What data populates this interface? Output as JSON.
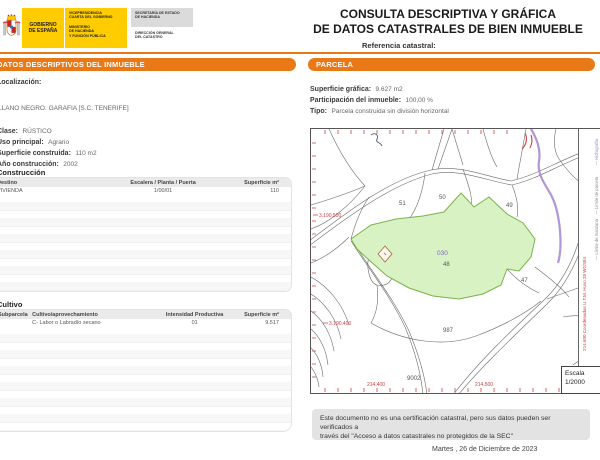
{
  "colors": {
    "accent_orange": "#E97817",
    "brand_yellow": "#FFCC00",
    "parcel_green": "#D9F2C4",
    "parcel_green_border": "#79B24A",
    "highlight_purple": "#7B68C8",
    "map_red": "#CC4040",
    "hydro_purple": "#A98BD4"
  },
  "header": {
    "gobierno_line1": "GOBIERNO",
    "gobierno_line2": "DE ESPAÑA",
    "vice_line1": "VICEPRESIDENCIA",
    "vice_line2": "CUARTA DEL GOBIERNO",
    "min_line1": "MINISTERIO",
    "min_line2": "DE HACIENDA",
    "min_line3": "Y FUNCIÓN PÚBLICA",
    "sec_line1": "SECRETARÍA DE ESTADO",
    "sec_line2": "DE HACIENDA",
    "dir_line1": "DIRECCIÓN GENERAL",
    "dir_line2": "DEL CATASTRO",
    "title_line1": "CONSULTA DESCRIPTIVA Y GRÁFICA",
    "title_line2": "DE DATOS CATASTRALES DE BIEN INMUEBLE",
    "ref_label": "Referencia catastral:"
  },
  "left": {
    "section_title": "DATOS DESCRIPTIVOS DEL INMUEBLE",
    "localizacion_label": "Localización:",
    "localizacion_value": "LLANO NEGRO. GARAFIA [S.C. TENERIFE]",
    "clase_label": "Clase:",
    "clase_value": "RÚSTICO",
    "uso_label": "Uso principal:",
    "uso_value": "Agrario",
    "superficie_label": "Superficie construida:",
    "superficie_value": "110 m2",
    "anio_label": "Año construcción:",
    "anio_value": "2002",
    "construccion": {
      "title": "Construcción",
      "headers": [
        "Destino",
        "Escalera / Planta / Puerta",
        "Superficie m²"
      ],
      "rows": [
        [
          "VIVIENDA",
          "1/00/01",
          "110"
        ]
      ]
    },
    "cultivo": {
      "title": "Cultivo",
      "headers": [
        "Subparcela",
        "Cultivo/aprovechamiento",
        "Intensidad Productiva",
        "Superficie m²"
      ],
      "rows": [
        [
          "",
          "C- Labor o Labradío secano",
          "01",
          "9.517"
        ]
      ]
    }
  },
  "right": {
    "section_title": "PARCELA",
    "superficie_label": "Superficie gráfica:",
    "superficie_value": "9.627 m2",
    "participacion_label": "Participación del inmueble:",
    "participacion_value": "100,00 %",
    "tipo_label": "Tipo:",
    "tipo_value": "Parcela construida sin división horizontal",
    "map": {
      "parcel_labels": [
        "51",
        "50",
        "49",
        "48",
        "47",
        "987",
        "9002"
      ],
      "highlight_label": "030",
      "coord_left_top": "3.190.500",
      "coord_left_bottom": "3.190.400",
      "coord_bottom_left": "214.400",
      "coord_bottom_right": "214.500",
      "legend_items": [
        "— Hidrografía",
        "— Límite zona verde",
        "— Límite de parcela",
        "— Mobiliario y aceras",
        "— Límite de manzana",
        "— Límite de construcciones"
      ],
      "utm_note": "214.600 Coordenadas U.T.M. Huso 28 WGS84",
      "escala_label": "Escala",
      "escala_value": "1/2000"
    }
  },
  "footer": {
    "notice_line1": "Este documento no es una certificación catastral, pero sus datos pueden ser verificados a",
    "notice_line2": "través del \"Acceso a datos catastrales no protegidos de la SEC\"",
    "date": "Martes , 26 de Diciembre de 2023"
  }
}
